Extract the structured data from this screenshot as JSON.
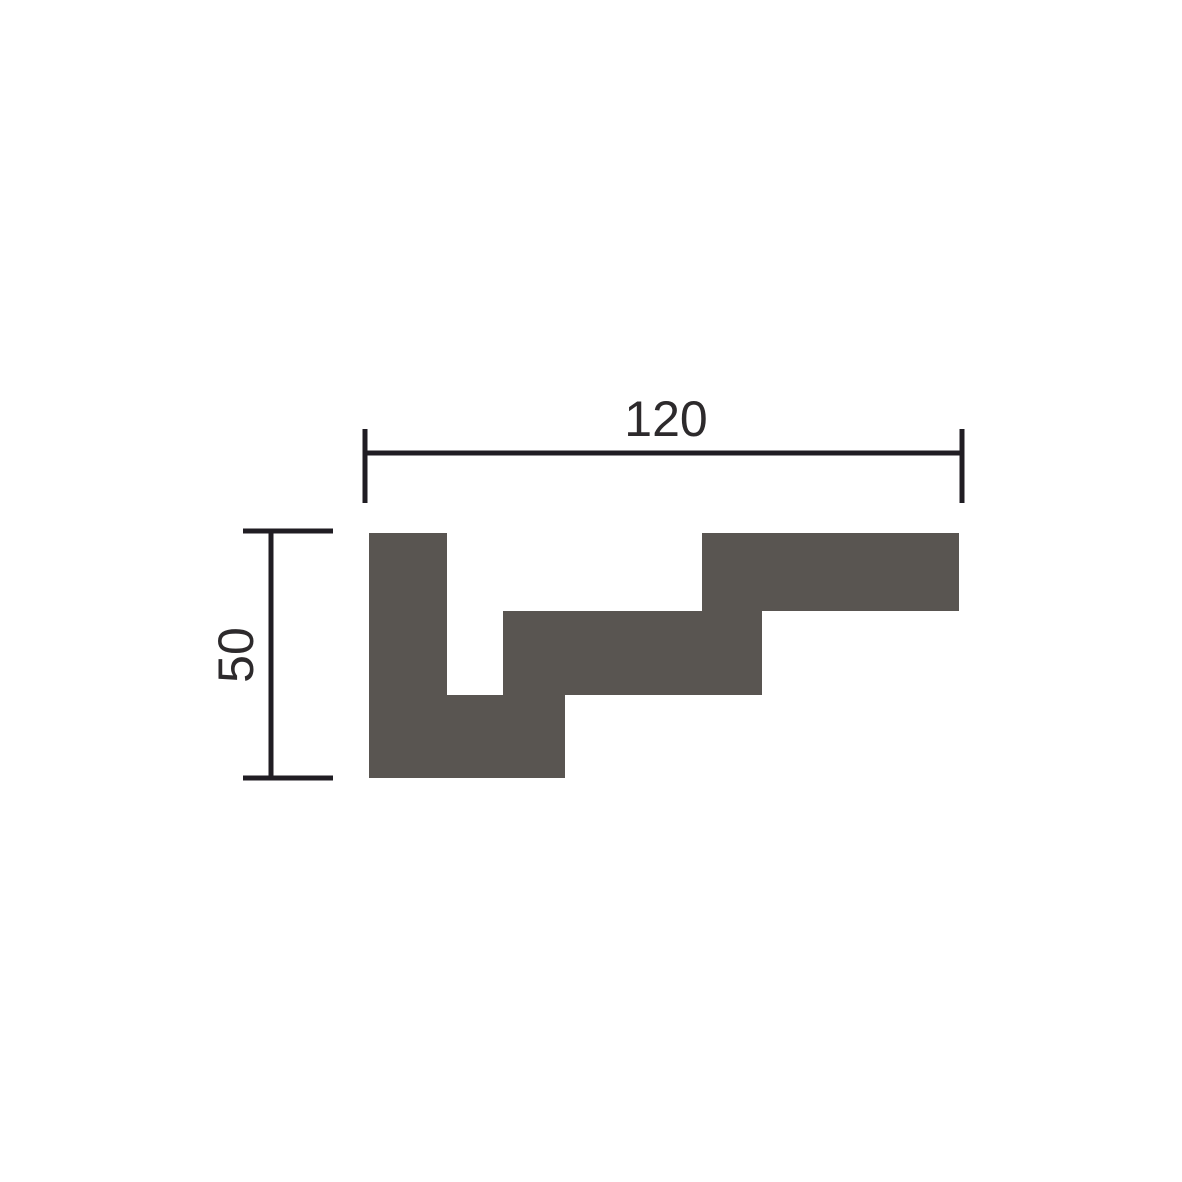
{
  "page": {
    "background": "#ffffff",
    "description": "Technical drawing: stepped cornice profile cross-section with width and height dimension lines"
  },
  "diagram": {
    "profile": {
      "fill_color": "#595551",
      "points": [
        [
          369,
          533
        ],
        [
          447,
          533
        ],
        [
          447,
          695
        ],
        [
          503,
          695
        ],
        [
          503,
          611
        ],
        [
          702,
          611
        ],
        [
          702,
          533
        ],
        [
          959,
          533
        ],
        [
          959,
          611
        ],
        [
          762,
          611
        ],
        [
          762,
          695
        ],
        [
          565,
          695
        ],
        [
          565,
          778
        ],
        [
          369,
          778
        ]
      ]
    },
    "dimension_style": {
      "line_color": "#201d23",
      "line_width": 5,
      "text_color": "#2d2a2c",
      "font_size_px": 50
    },
    "width_dimension": {
      "label": "120",
      "line": [
        365,
        453,
        962,
        453
      ],
      "ticks": [
        [
          365,
          429,
          365,
          503
        ],
        [
          962,
          429,
          962,
          503
        ]
      ],
      "label_center": [
        666,
        419
      ]
    },
    "height_dimension": {
      "label": "50",
      "line": [
        271,
        531,
        271,
        778
      ],
      "ticks": [
        [
          243,
          531,
          333,
          531
        ],
        [
          243,
          778,
          333,
          778
        ]
      ],
      "label_center": [
        236,
        655
      ]
    }
  }
}
